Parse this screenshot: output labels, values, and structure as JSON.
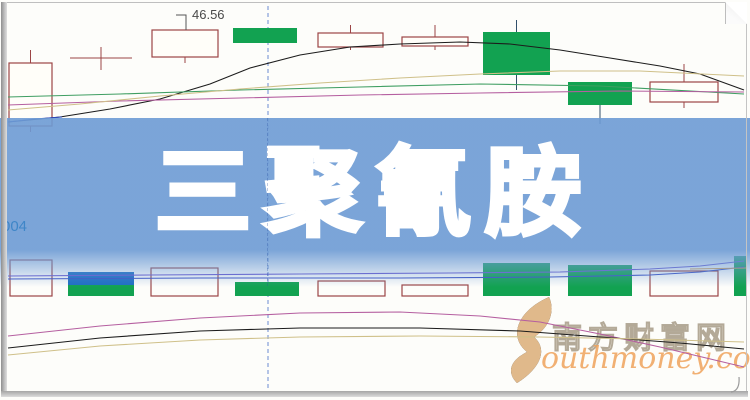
{
  "banner": {
    "title": "三聚氰胺"
  },
  "price_marker": {
    "value": "46.56"
  },
  "axis_label": {
    "value": "004"
  },
  "watermark": {
    "cn": "南方财富网",
    "en": "outhmoney.com"
  },
  "chart_data": {
    "type": "candlestick",
    "title": "三聚氰胺",
    "subtitle_annotation": "46.56",
    "legend": [],
    "axes_visible": false,
    "colors": {
      "candle_outline": "#9c4545",
      "candle_green": "#12a251",
      "green_wick": "#31506b",
      "ma_black": "#1c1c1c",
      "ma_green": "#3f9e62",
      "ma_magenta": "#b55fa0",
      "ma_tan": "#cfc089",
      "ma_blue": "#2a48c0",
      "vol_purple": "#6a5ace",
      "vol_blue": "#3a50c2",
      "vol_tan": "#d8a050",
      "dash_line": "#6b8cd2",
      "pointer": "#555555"
    },
    "price_pane": {
      "candles": [
        {
          "x": 9,
          "w": 43,
          "top": 63,
          "bottom": 126,
          "wick_top": 50,
          "wick_bottom": 132,
          "kind": "hollow"
        },
        {
          "x": 70,
          "w": 62,
          "top": 58,
          "bottom": 58,
          "wick_top": 47,
          "wick_bottom": 70,
          "kind": "doji"
        },
        {
          "x": 152,
          "w": 66,
          "top": 30,
          "bottom": 57,
          "wick_top": 30,
          "wick_bottom": 63,
          "kind": "hollow",
          "label": "46.56"
        },
        {
          "x": 233,
          "w": 64,
          "top": 28,
          "bottom": 43,
          "wick_top": 28,
          "wick_bottom": 43,
          "kind": "green"
        },
        {
          "x": 318,
          "w": 65,
          "top": 33,
          "bottom": 47,
          "wick_top": 25,
          "wick_bottom": 50,
          "kind": "hollow"
        },
        {
          "x": 402,
          "w": 66,
          "top": 37,
          "bottom": 46,
          "wick_top": 25,
          "wick_bottom": 50,
          "kind": "hollow"
        },
        {
          "x": 483,
          "w": 67,
          "top": 32,
          "bottom": 75,
          "wick_top": 20,
          "wick_bottom": 90,
          "kind": "green"
        },
        {
          "x": 568,
          "w": 64,
          "top": 82,
          "bottom": 105,
          "wick_top": 82,
          "wick_bottom": 124,
          "kind": "green"
        },
        {
          "x": 650,
          "w": 68,
          "top": 82,
          "bottom": 102,
          "wick_top": 64,
          "wick_bottom": 108,
          "kind": "hollow"
        }
      ],
      "pointer": [
        [
          176,
          15
        ],
        [
          186,
          15
        ],
        [
          186,
          30
        ]
      ],
      "lines": [
        {
          "name": "ma-black",
          "color": "ma_black",
          "points": [
            [
              8,
              122
            ],
            [
              60,
              117
            ],
            [
              110,
              109
            ],
            [
              160,
              99
            ],
            [
              210,
              84
            ],
            [
              250,
              68
            ],
            [
              300,
              55
            ],
            [
              350,
              47
            ],
            [
              400,
              44
            ],
            [
              460,
              42
            ],
            [
              510,
              44
            ],
            [
              560,
              50
            ],
            [
              610,
              58
            ],
            [
              660,
              66
            ],
            [
              700,
              74
            ],
            [
              744,
              90
            ]
          ]
        },
        {
          "name": "ma-green",
          "color": "ma_green",
          "points": [
            [
              8,
              97
            ],
            [
              120,
              94
            ],
            [
              240,
              90
            ],
            [
              360,
              87
            ],
            [
              480,
              84
            ],
            [
              600,
              86
            ],
            [
              744,
              94
            ]
          ]
        },
        {
          "name": "ma-magenta",
          "color": "ma_magenta",
          "points": [
            [
              8,
              105
            ],
            [
              120,
              101
            ],
            [
              240,
              98
            ],
            [
              360,
              95
            ],
            [
              480,
              93
            ],
            [
              620,
              91
            ],
            [
              744,
              92
            ]
          ]
        },
        {
          "name": "ma-tan",
          "color": "ma_tan",
          "points": [
            [
              8,
              110
            ],
            [
              80,
              104
            ],
            [
              160,
              96
            ],
            [
              240,
              89
            ],
            [
              320,
              83
            ],
            [
              400,
              78
            ],
            [
              480,
              74
            ],
            [
              560,
              71
            ],
            [
              640,
              71
            ],
            [
              744,
              76
            ]
          ]
        },
        {
          "name": "ma-blue",
          "color": "ma_blue",
          "points": [
            [
              8,
              122
            ],
            [
              35,
              119
            ],
            [
              62,
              117
            ]
          ]
        }
      ]
    },
    "volume_pane": {
      "baseline": 296,
      "bars": [
        {
          "x": 10,
          "w": 42,
          "top": 260,
          "kind": "hollow"
        },
        {
          "x": 68,
          "w": 66,
          "top": 272,
          "kind": "green",
          "cap_bottom": 285,
          "cap_color": "#1e6ec2"
        },
        {
          "x": 151,
          "w": 67,
          "top": 268,
          "kind": "hollow"
        },
        {
          "x": 235,
          "w": 64,
          "top": 282,
          "kind": "green"
        },
        {
          "x": 318,
          "w": 67,
          "top": 281,
          "kind": "hollow"
        },
        {
          "x": 402,
          "w": 66,
          "top": 285,
          "kind": "hollow"
        },
        {
          "x": 483,
          "w": 67,
          "top": 263,
          "kind": "green"
        },
        {
          "x": 568,
          "w": 64,
          "top": 265,
          "kind": "green"
        },
        {
          "x": 650,
          "w": 68,
          "top": 271,
          "kind": "hollow"
        },
        {
          "x": 734,
          "w": 12,
          "top": 256,
          "kind": "green"
        }
      ],
      "lines": [
        {
          "name": "vol-ma-purple",
          "color": "vol_purple",
          "points": [
            [
              8,
              276
            ],
            [
              150,
              275
            ],
            [
              300,
              274
            ],
            [
              450,
              273
            ],
            [
              560,
              272
            ],
            [
              650,
              269
            ],
            [
              700,
              266
            ],
            [
              744,
              261
            ]
          ]
        },
        {
          "name": "vol-ma-blue",
          "color": "vol_blue",
          "points": [
            [
              8,
              279
            ],
            [
              200,
              278
            ],
            [
              400,
              278
            ],
            [
              550,
              277
            ],
            [
              650,
              275
            ],
            [
              700,
              272
            ],
            [
              744,
              267
            ]
          ]
        },
        {
          "name": "vol-ma-tan",
          "color": "vol_tan",
          "points": [
            [
              690,
              269
            ],
            [
              746,
              268
            ]
          ]
        }
      ]
    },
    "indicator_pane": {
      "lines": [
        {
          "name": "ind-magenta",
          "color": "ma_magenta",
          "points": [
            [
              8,
              336
            ],
            [
              100,
              326
            ],
            [
              200,
              318
            ],
            [
              300,
              313
            ],
            [
              400,
              312
            ],
            [
              480,
              316
            ],
            [
              540,
              322
            ],
            [
              600,
              334
            ],
            [
              660,
              347
            ],
            [
              744,
              367
            ]
          ]
        },
        {
          "name": "ind-black",
          "color": "ma_black",
          "points": [
            [
              8,
              348
            ],
            [
              100,
              338
            ],
            [
              200,
              331
            ],
            [
              300,
              328
            ],
            [
              420,
              328
            ],
            [
              520,
              331
            ],
            [
              600,
              337
            ],
            [
              680,
              343
            ],
            [
              744,
              349
            ]
          ]
        },
        {
          "name": "ind-tan",
          "color": "ma_tan",
          "points": [
            [
              8,
              355
            ],
            [
              100,
              346
            ],
            [
              200,
              340
            ],
            [
              300,
              337
            ],
            [
              420,
              336
            ],
            [
              540,
              337
            ],
            [
              640,
              339
            ],
            [
              744,
              342
            ]
          ]
        }
      ]
    },
    "dashed_vline": {
      "x": 268,
      "y1": 6,
      "y2": 391
    }
  }
}
